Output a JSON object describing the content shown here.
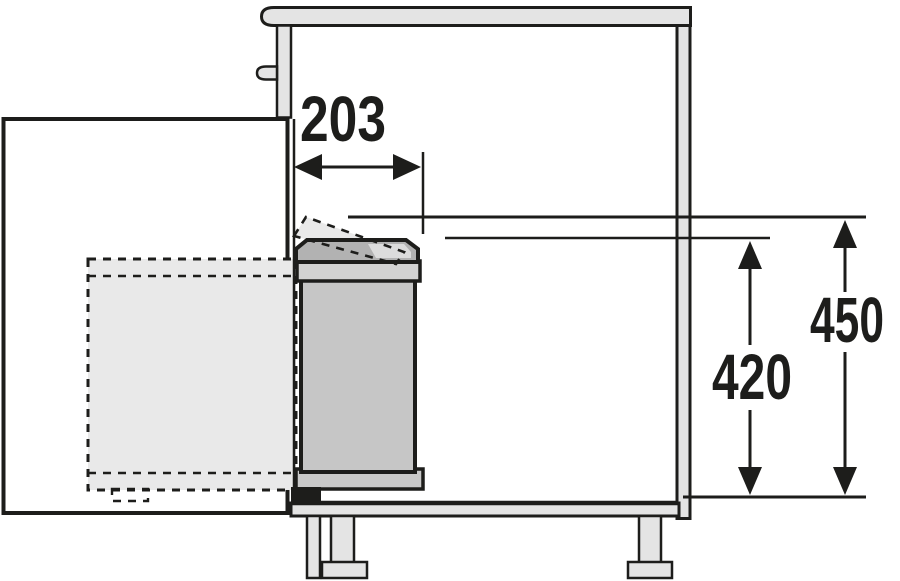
{
  "figure": {
    "type": "technical-drawing",
    "subject": "base-cabinet-with-swing-out-waste-bin-side-section",
    "labels": {
      "opening_width": "203",
      "bin_height": "420",
      "lid_open_height": "450"
    },
    "colors": {
      "line": "#1d1d1b",
      "panel": "#e4e4e4",
      "bin_body": "#c6c6c6",
      "bin_lid": "#b2b2b2",
      "bin_collar": "#d2d2d2",
      "bin_base": "#c9c9c9",
      "ghost_fill": "#e9e9e9",
      "lid_highlight": "#dcdcdc",
      "background": "#ffffff"
    }
  }
}
